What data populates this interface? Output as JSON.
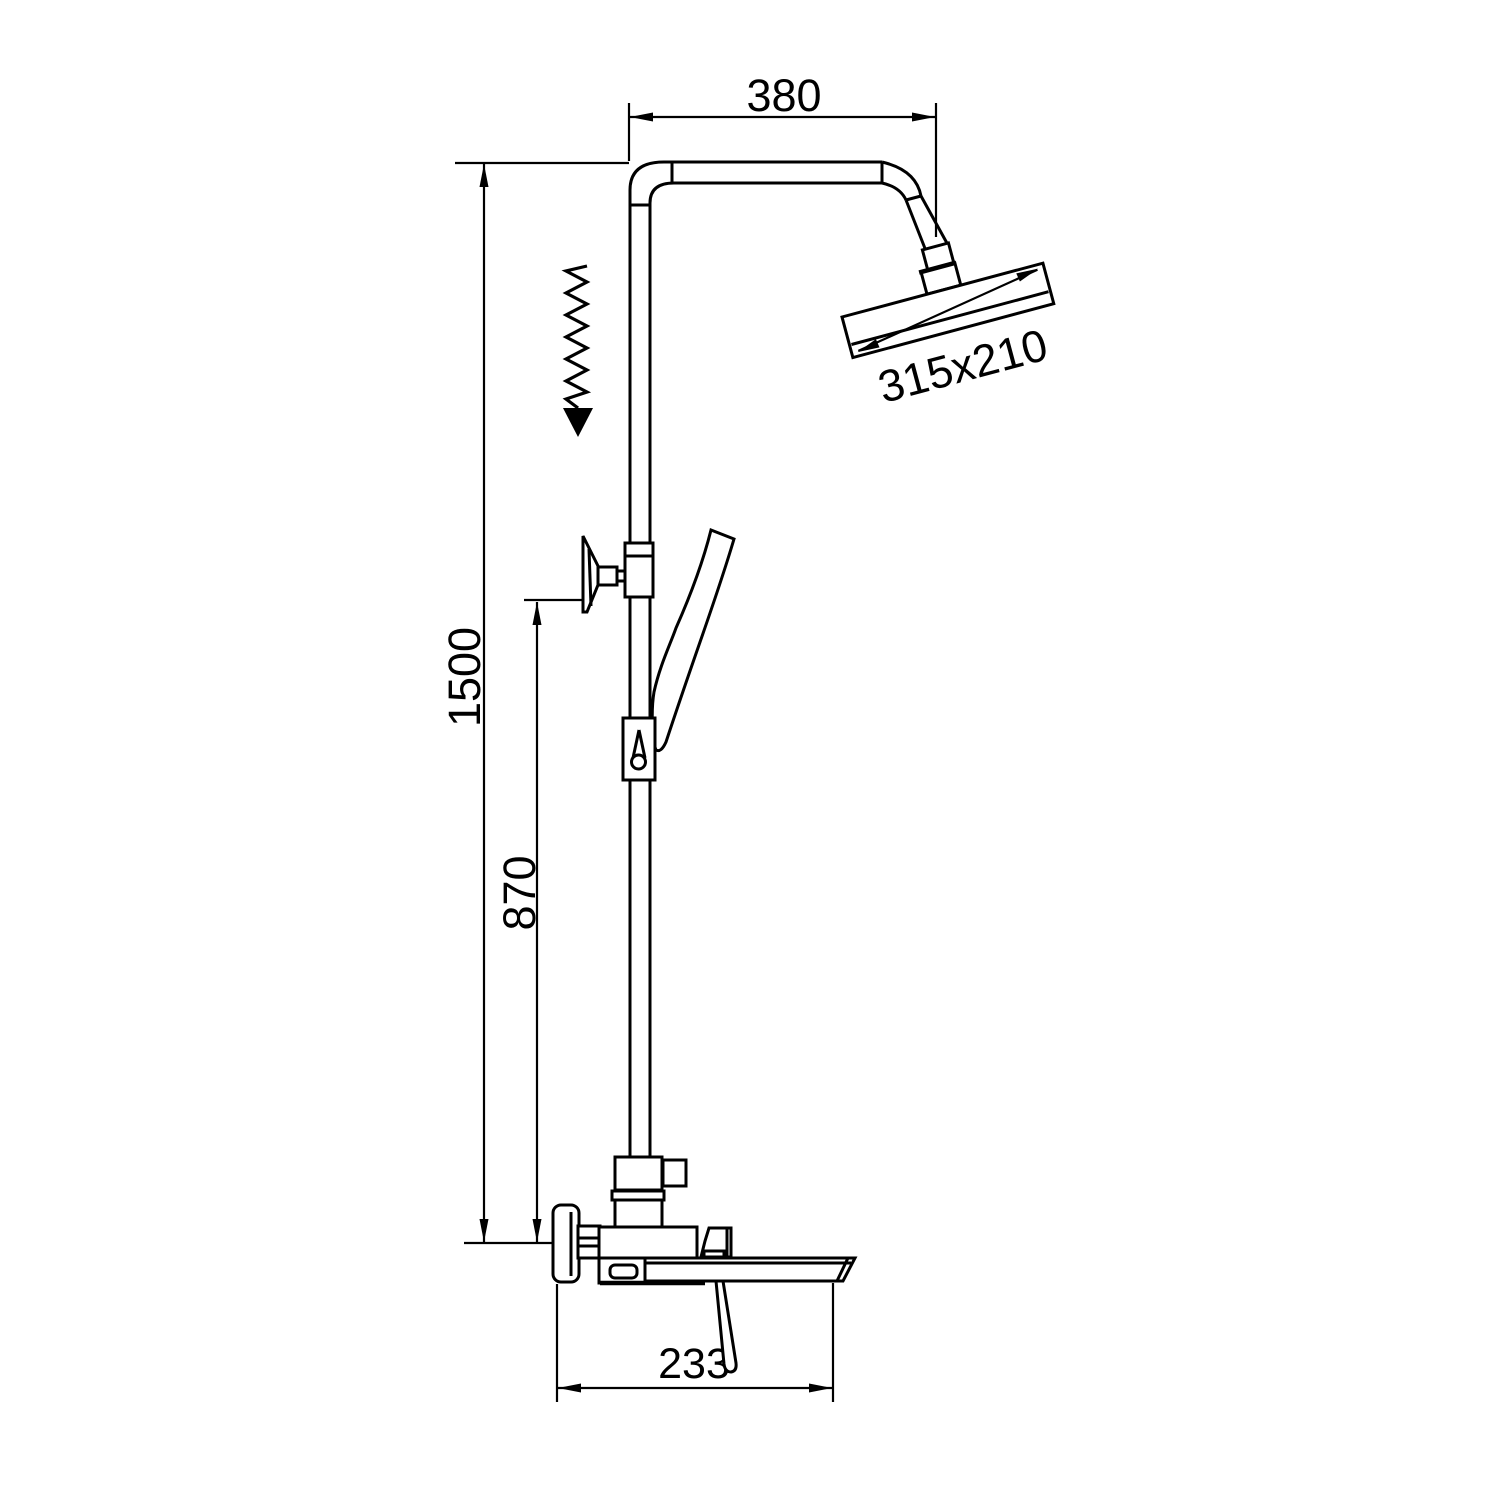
{
  "drawing": {
    "kind": "technical-dimension-diagram",
    "subject": "shower-column-with-rain-head-hand-shower-and-spout",
    "background_color": "#ffffff",
    "line_color": "#000000",
    "labels": {
      "top_arm_width": "380",
      "head_size": "315x210",
      "total_height": "1500",
      "slider_height": "870",
      "spout_length": "233"
    },
    "icons": {
      "height_adjust_icon": "zigzag-down-arrow"
    }
  }
}
